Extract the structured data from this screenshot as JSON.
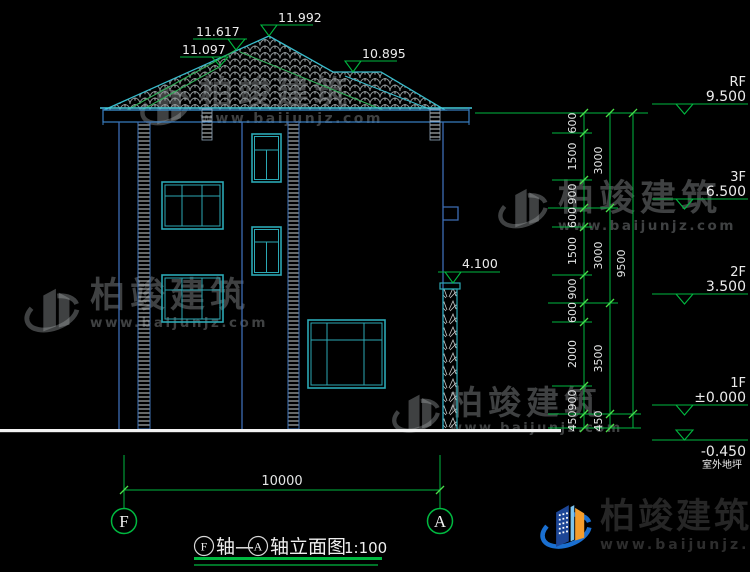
{
  "drawing": {
    "roof_levels": {
      "left_lower": "11.097",
      "left_upper": "11.617",
      "peak": "11.992",
      "right": "10.895"
    },
    "column_level": "4.100",
    "levels": [
      {
        "floor": "RF",
        "value": "9.500"
      },
      {
        "floor": "3F",
        "value": "6.500"
      },
      {
        "floor": "2F",
        "value": "3.500"
      },
      {
        "floor": "1F",
        "value": "±0.000"
      },
      {
        "floor": "室外地坪",
        "value": "-0.450"
      }
    ],
    "dims_col1": [
      "600",
      "1500",
      "900",
      "600",
      "1500",
      "900",
      "600",
      "2000",
      "900",
      "450"
    ],
    "dims_col2": [
      "3000",
      "3000",
      "3500",
      "450"
    ],
    "dims_total": "9500",
    "width_dim": "10000",
    "axes": {
      "left": "F",
      "right": "A"
    },
    "title": {
      "axis_left": "F",
      "connector": "轴—",
      "axis_right": "A",
      "name": "轴立面图",
      "scale": "1:100"
    }
  },
  "watermark": {
    "brand": "柏竣建筑",
    "site": "www.baijunjz.com"
  },
  "colors": {
    "dim_green": "#00b840",
    "wall_blue": "#3c6cb4",
    "bright_cyan": "#41c8d8",
    "frame_teal": "#2ba8b4",
    "text_white": "#e8e8e8",
    "logo_blue": "#1a6fd0",
    "logo_orange": "#f59d2c"
  }
}
